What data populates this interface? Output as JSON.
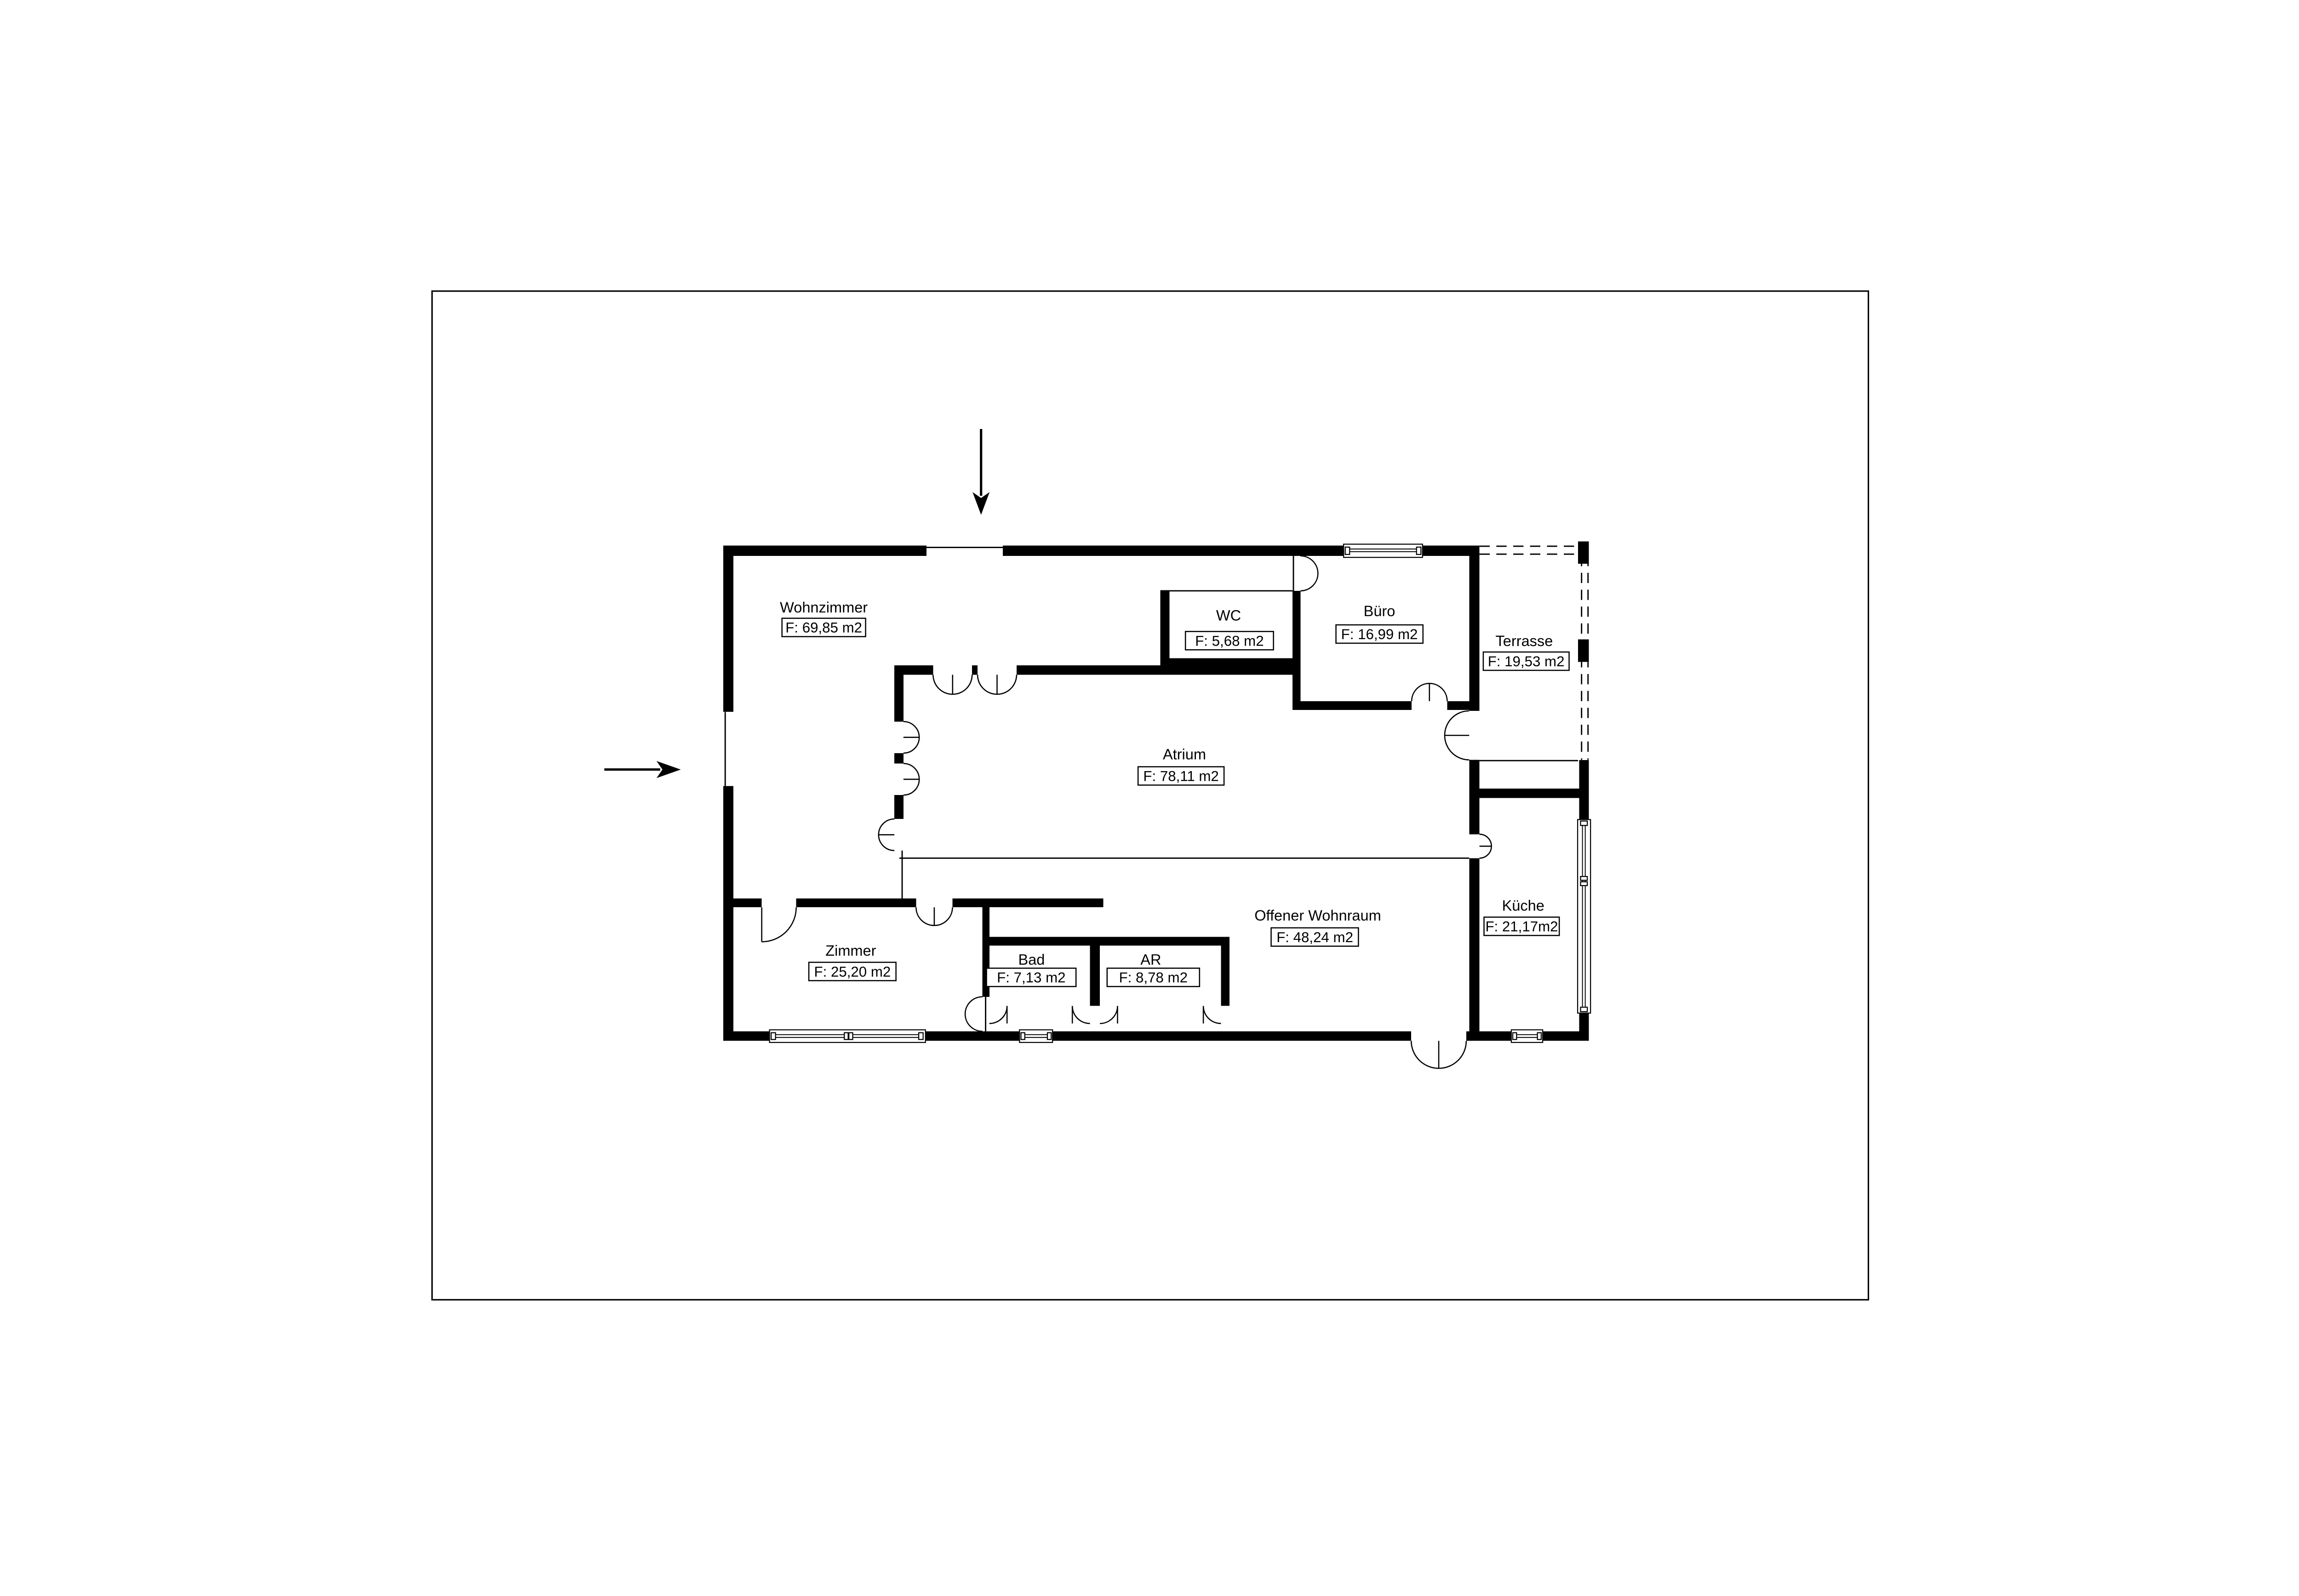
{
  "plan": {
    "rooms": {
      "wohnzimmer": {
        "name": "Wohnzimmer",
        "area": "F: 69,85 m2"
      },
      "wc": {
        "name": "WC",
        "area": "F: 5,68 m2"
      },
      "buero": {
        "name": "Büro",
        "area": "F: 16,99 m2"
      },
      "terrasse": {
        "name": "Terrasse",
        "area": "F: 19,53 m2"
      },
      "atrium": {
        "name": "Atrium",
        "area": "F: 78,11 m2"
      },
      "offener_wohnraum": {
        "name": "Offener Wohnraum",
        "area": "F: 48,24 m2"
      },
      "kueche": {
        "name": "Küche",
        "area": "F: 21,17m2"
      },
      "zimmer": {
        "name": "Zimmer",
        "area": "F: 25,20 m2"
      },
      "bad": {
        "name": "Bad",
        "area": "F: 7,13 m2"
      },
      "ar": {
        "name": "AR",
        "area": "F: 8,78 m2"
      }
    },
    "icons": {
      "north_arrow": "entrance-arrow-down",
      "west_arrow": "entrance-arrow-right"
    },
    "colors": {
      "wall": "#000000",
      "background": "#ffffff"
    }
  }
}
